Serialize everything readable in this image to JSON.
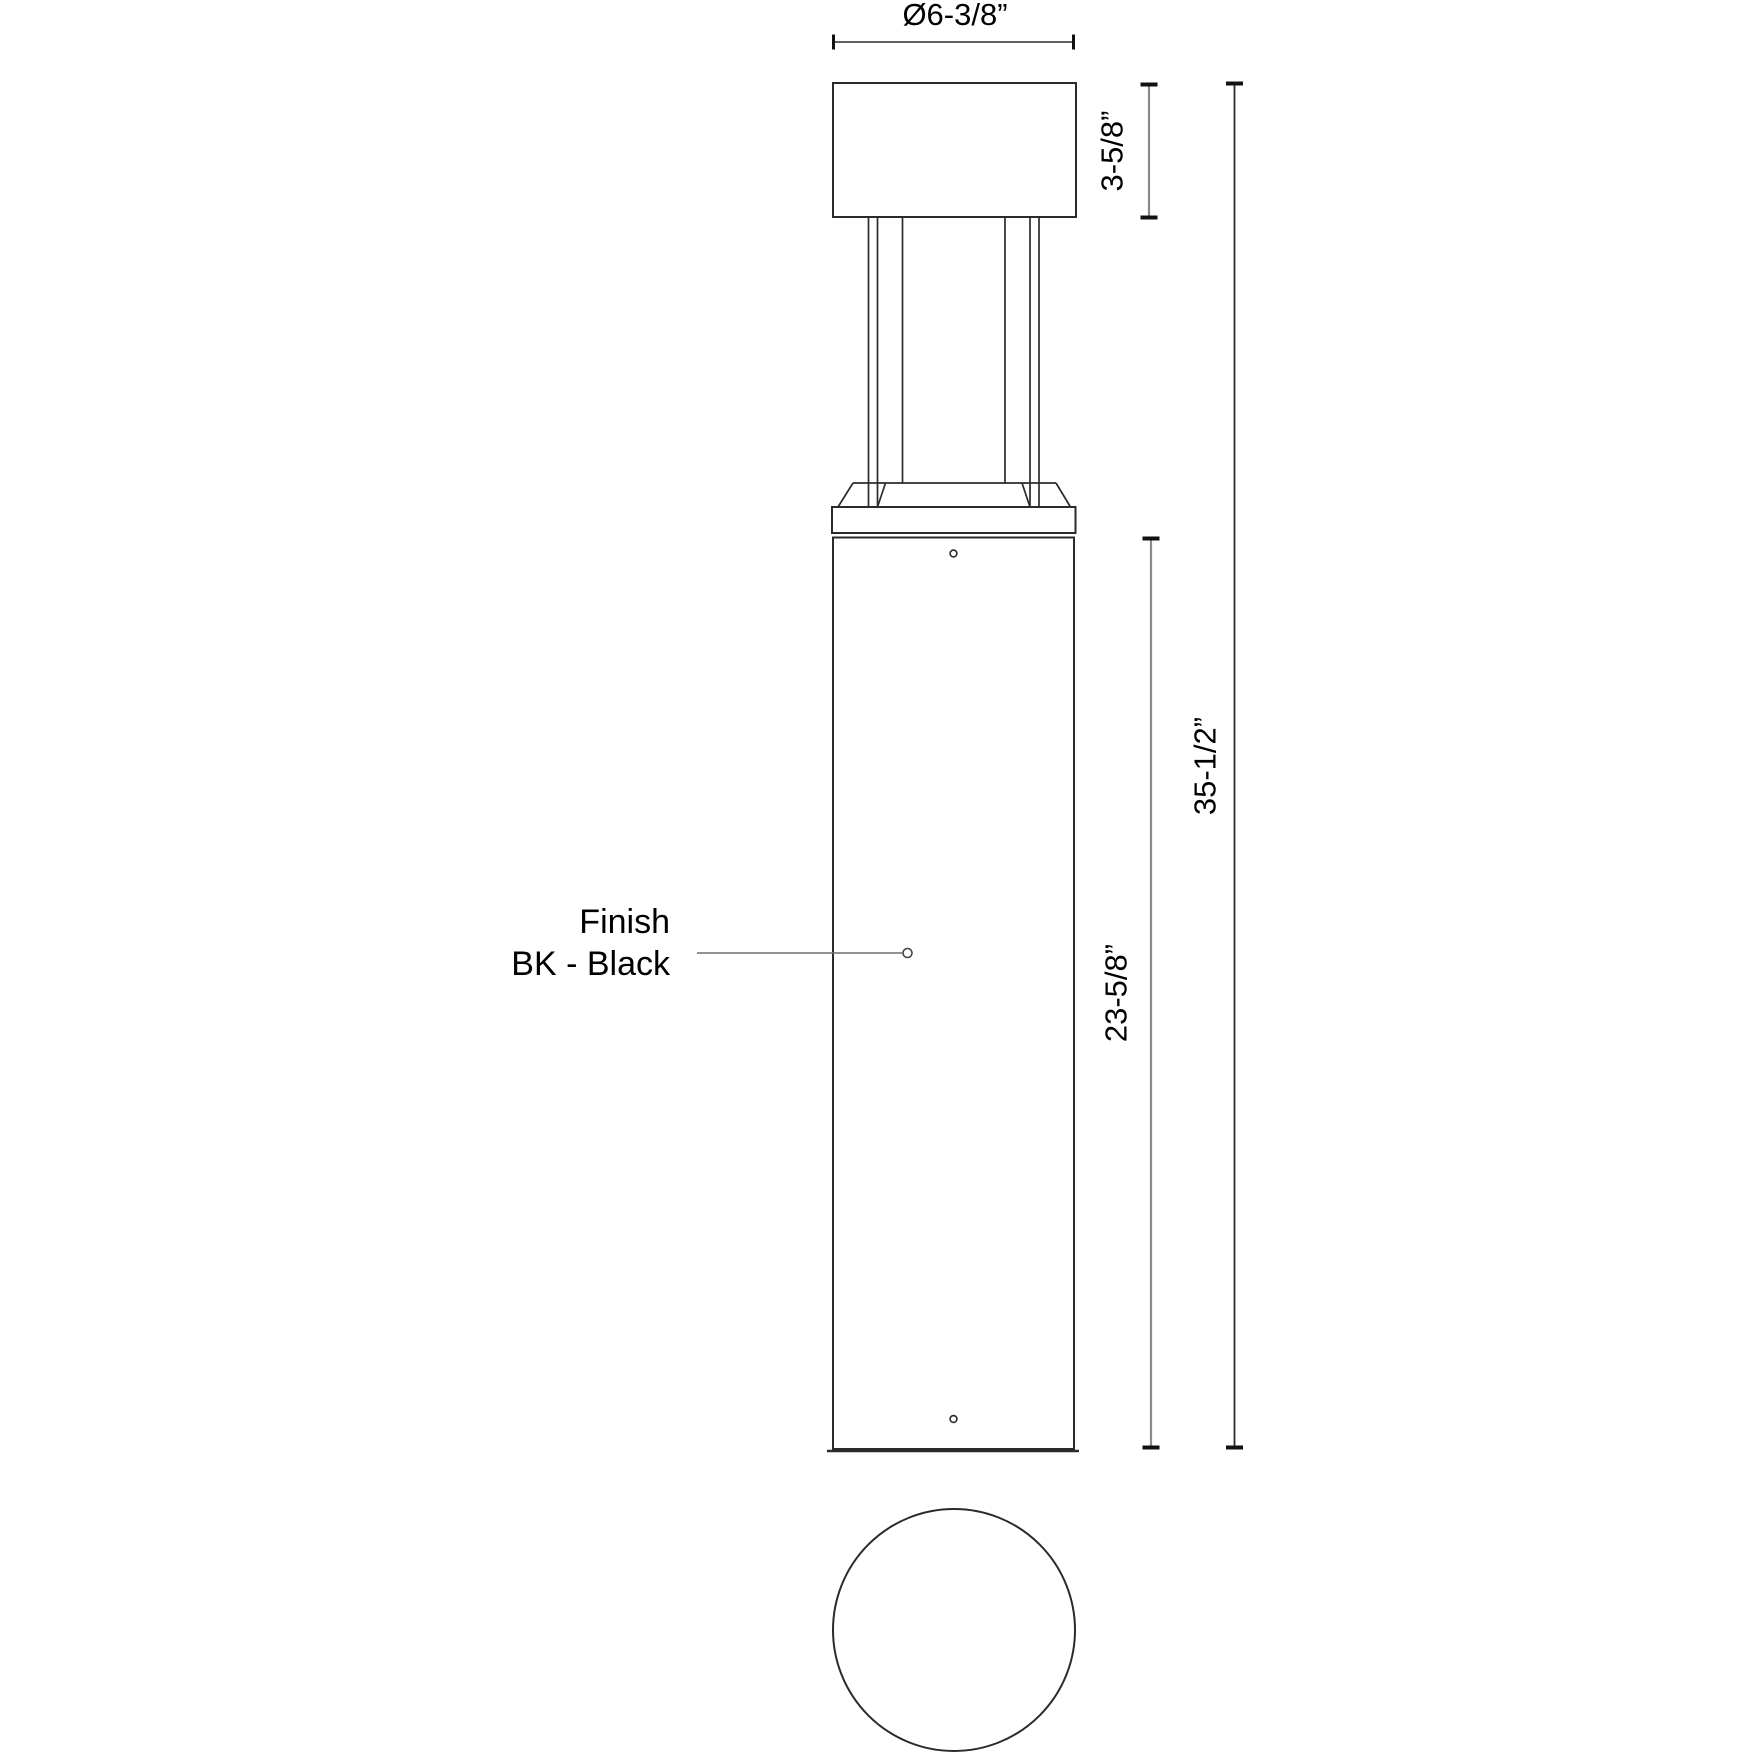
{
  "drawing": {
    "title": "bollard-fixture-dimension-drawing",
    "dimensions": {
      "diameter": "Ø6-3/8”",
      "cap_height": "3-5/8”",
      "overall_height": "35-1/2”",
      "body_height": "23-5/8”"
    },
    "finish_label": {
      "line1": "Finish",
      "line2": "BK - Black"
    },
    "colors": {
      "background": "#ffffff",
      "outline": "#2b2b2b",
      "dim_gray": "#8a8a8a",
      "dim_dark": "#2b2b2b",
      "tick": "#111111",
      "leader": "#6e6e6e",
      "text": "#000000"
    }
  }
}
